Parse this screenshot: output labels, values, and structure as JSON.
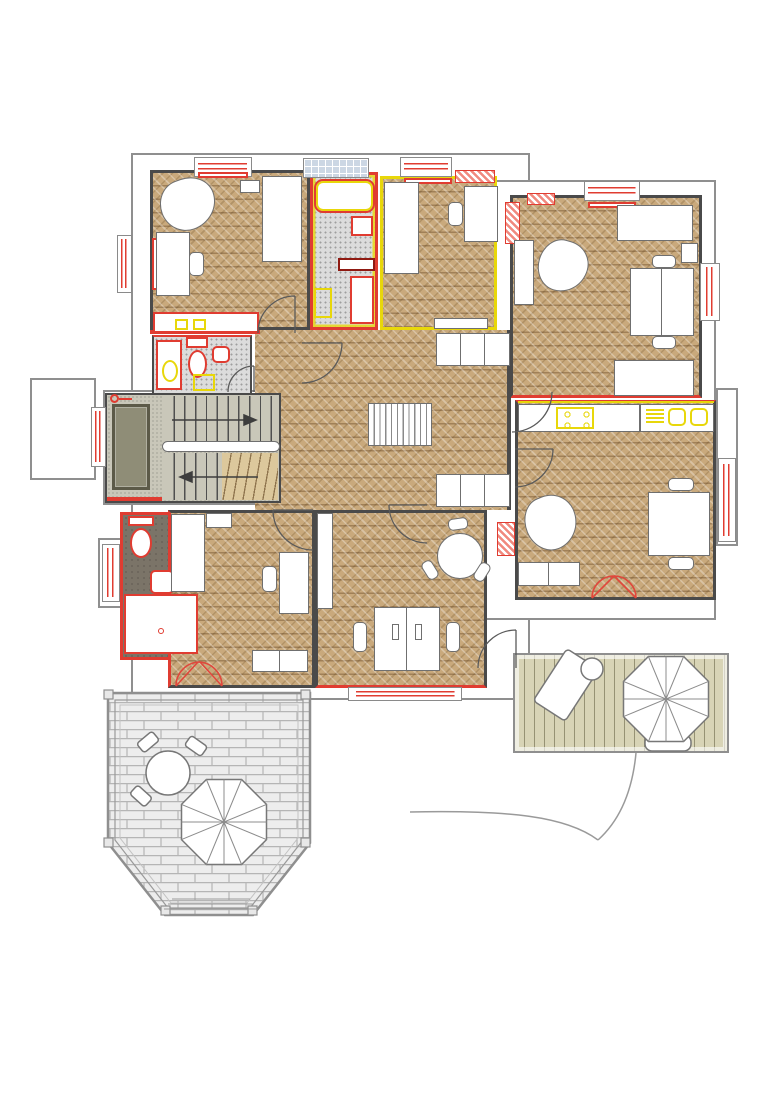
{
  "document": {
    "kind": "architectural floor plan drawing",
    "visible_text": "none",
    "view": "top-down plan of one storey with two outdoor terraces",
    "annotation_colors": {
      "red_lines": "plumbing fixtures, radiators, window frames and marked walls",
      "yellow_lines": "kitchen / wet-area fittings and marked partitions",
      "dark_gray": "interior walls",
      "light_gray": "exterior envelope and balustrades"
    }
  },
  "palette": {
    "wood": "#c9a97c",
    "tile": "#dcdcdc",
    "tileDot": "#9e9e9e",
    "darkFloor": "#7b7468",
    "concrete": "#c9c7b9",
    "deck": "#d8d4b6",
    "brick": "#ededed",
    "brickLine": "#b5b5b5",
    "wall": "#4a4a4a",
    "outline": "#8f8f8f",
    "red": "#e03c31",
    "darkRed": "#8f1a12",
    "yellow": "#e8d70a",
    "glassBlue": "#ccd7e4",
    "rug": "#8f8d77",
    "stairWood": "#dcc89c"
  },
  "rooms": [
    {
      "id": "bedroom-nw",
      "floor": "herringbone wood",
      "furniture": [
        "armchair",
        "desk",
        "desk-chair",
        "bed",
        "shelf",
        "red-marked counter with yellow boxes"
      ]
    },
    {
      "id": "bathroom-n",
      "floor": "gray mosaic tile",
      "furniture": [
        "bathtub",
        "wall-sink",
        "dark-red shelf",
        "vanity-counter",
        "yellow appliance"
      ]
    },
    {
      "id": "bedroom-n",
      "floor": "herringbone wood",
      "walls": "yellow-marked",
      "furniture": [
        "bed",
        "desk",
        "desk-chair",
        "low shelf"
      ]
    },
    {
      "id": "living-ne",
      "floor": "herringbone wood",
      "furniture": [
        "sofa-top",
        "tall cabinet",
        "double desk at window",
        "2 desk-chairs",
        "bed-bottom",
        "armchair"
      ]
    },
    {
      "id": "hall",
      "floor": "herringbone wood",
      "furniture": [
        "wardrobe-north",
        "wardrobe-south",
        "free-standing radiator"
      ]
    },
    {
      "id": "wc",
      "floor": "gray mosaic tile",
      "furniture": [
        "washing-machine",
        "toilet",
        "hand-basin",
        "yellow floor box"
      ]
    },
    {
      "id": "stairwell",
      "floor": "concrete",
      "furniture": [
        "doormat-rug",
        "stair flight up with arrow",
        "handrail",
        "stair flight down with winders"
      ]
    },
    {
      "id": "bathroom-w",
      "floor": "dark gray screed",
      "walls": "red-marked",
      "furniture": [
        "toilet",
        "hand-basin",
        "shower-tray"
      ]
    },
    {
      "id": "bedroom-sw",
      "floor": "herringbone wood",
      "furniture": [
        "bed",
        "shelf",
        "desk",
        "desk-chair",
        "low cabinets",
        "red french door to terrace"
      ]
    },
    {
      "id": "office-s",
      "floor": "herringbone wood",
      "furniture": [
        "wardrobe",
        "round meeting table",
        "3 chairs",
        "back-to-back double desk",
        "2 desk-chairs",
        "2 monitors"
      ]
    },
    {
      "id": "kitchen-dining-e",
      "floor": "herringbone wood",
      "furniture": [
        "counter with yellow cooktop",
        "counter with yellow double sink",
        "yellow vent",
        "dining table",
        "2 chairs",
        "armchair",
        "low cabinets",
        "red french door to deck"
      ]
    }
  ],
  "outdoor": [
    {
      "id": "balcony-w",
      "finish": "plain"
    },
    {
      "id": "terrace-sw",
      "finish": "stone paving, octagonal bay with balustrade",
      "furniture": [
        "round table",
        "4 chairs",
        "parasol",
        "steps"
      ]
    },
    {
      "id": "deck-se",
      "finish": "wood planks",
      "furniture": [
        "lounge chair",
        "side table",
        "parasol",
        "table under parasol"
      ],
      "extras": [
        "curved garden path"
      ]
    }
  ],
  "symbols": {
    "window-icon": "double red glazing lines in white frame",
    "glass-block-window-icon": "blue grid panel",
    "chimney-icon": "red diagonal hatch block",
    "door-arc-icon": "quarter-circle swing",
    "stair-arrow-icon": "direction of travel",
    "parasol-icon": "octagon with eight spokes"
  },
  "counts": {
    "windows": 10,
    "door_swings": 8,
    "french_doors": 2,
    "parasols": 2,
    "chimneys": 4
  }
}
